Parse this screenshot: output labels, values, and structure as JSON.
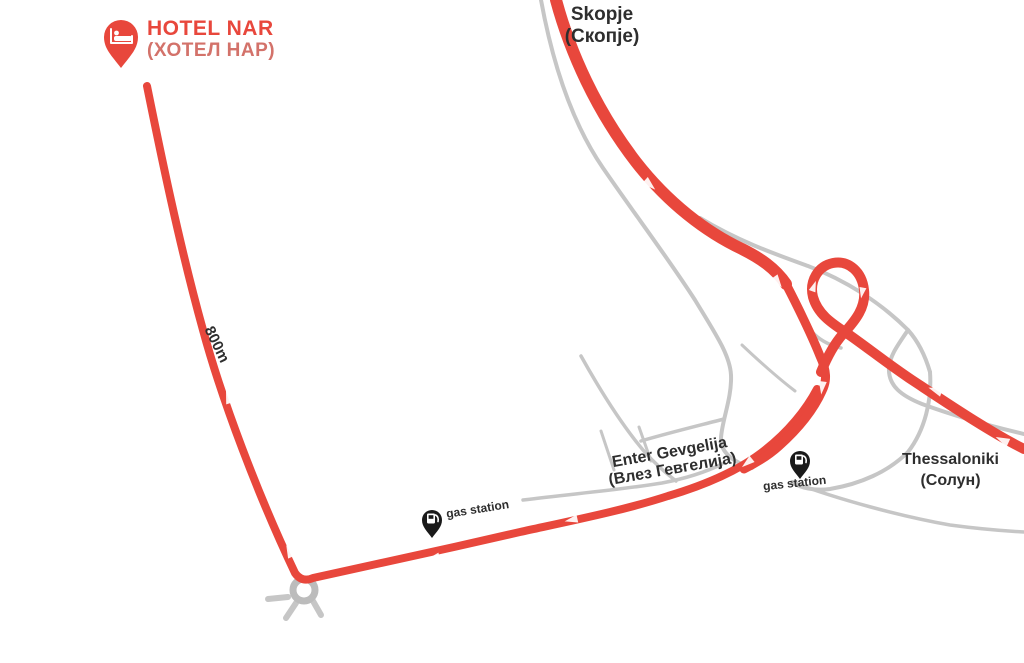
{
  "map": {
    "hotel": {
      "name": "HOTEL NAR",
      "name_cyrillic": "(ХОТЕЛ НАР)"
    },
    "destinations": {
      "skopje": {
        "en": "Skopje",
        "cyr": "(Скопје)"
      },
      "thessaloniki": {
        "en": "Thessaloniki",
        "cyr": "(Солун)"
      },
      "enter_gevgelija": {
        "en": "Enter Gevgelija",
        "cyr": "(Влез Гевгелија)"
      }
    },
    "markers": {
      "gas_station_left": "gas station",
      "gas_station_right": "gas station",
      "distance": "800m"
    },
    "icons": {
      "hotel_pin": "bed-map-pin",
      "gas_pin": "fuel-map-pin",
      "route_arrow": "direction-arrow",
      "roundabout": "roundabout-circle"
    },
    "colors": {
      "route": "#e8473c",
      "route_light": "#d3726a",
      "road_gray": "#c6c6c6",
      "text_dark": "#2e2e2e",
      "pin_black": "#1a1a1a"
    }
  }
}
